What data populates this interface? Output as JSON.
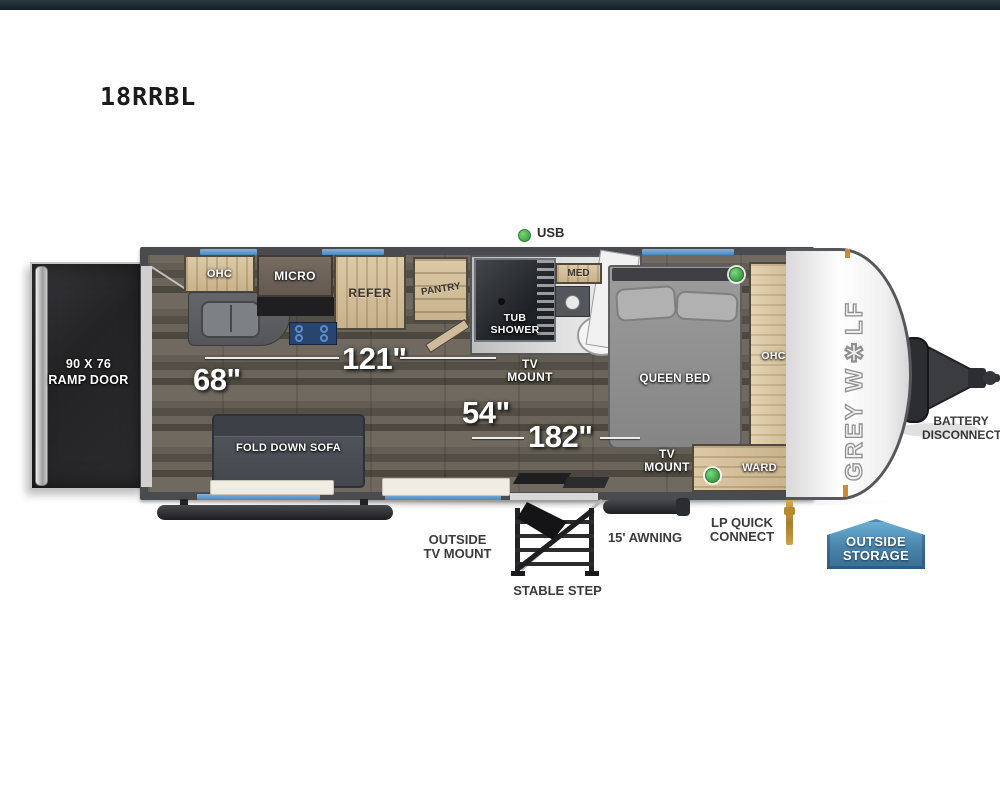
{
  "header": {
    "model": "18RRBL"
  },
  "plan": {
    "usb": "USB",
    "ramp_door": {
      "line1": "90 X 76",
      "line2": "RAMP DOOR"
    },
    "kitchen": {
      "ohc": "OHC",
      "micro": "MICRO",
      "refer": "REFER",
      "pantry": "PANTRY"
    },
    "bath": {
      "tub_line1": "TUB",
      "tub_line2": "SHOWER",
      "med": "MED"
    },
    "living": {
      "sofa": "FOLD DOWN SOFA",
      "tv_mount_line1": "TV",
      "tv_mount_line2": "MOUNT"
    },
    "bedroom": {
      "bed": "QUEEN BED",
      "ohc": "OHC",
      "tv_mount_line1": "TV",
      "tv_mount_line2": "MOUNT",
      "ward": "WARD"
    },
    "dimensions": {
      "garage_width": "68\"",
      "garage_length": "121\"",
      "mid_width": "54\"",
      "main_length": "182\""
    }
  },
  "exterior": {
    "outside_tv_line1": "OUTSIDE",
    "outside_tv_line2": "TV MOUNT",
    "stable_step": "STABLE STEP",
    "awning": "15' AWNING",
    "lp_line1": "LP QUICK",
    "lp_line2": "CONNECT",
    "storage_line1": "OUTSIDE",
    "storage_line2": "STORAGE",
    "battery_line1": "BATTERY",
    "battery_line2": "DISCONNECT"
  },
  "brand": {
    "logo": "GREY W✱LF"
  },
  "colors": {
    "window_blue": "#5b9bd5",
    "indicator_green": "#3fae45",
    "storage_badge_blue": "#4a85ad",
    "topbar": "#1c282c",
    "wall_gray": "#4a4b4e"
  }
}
